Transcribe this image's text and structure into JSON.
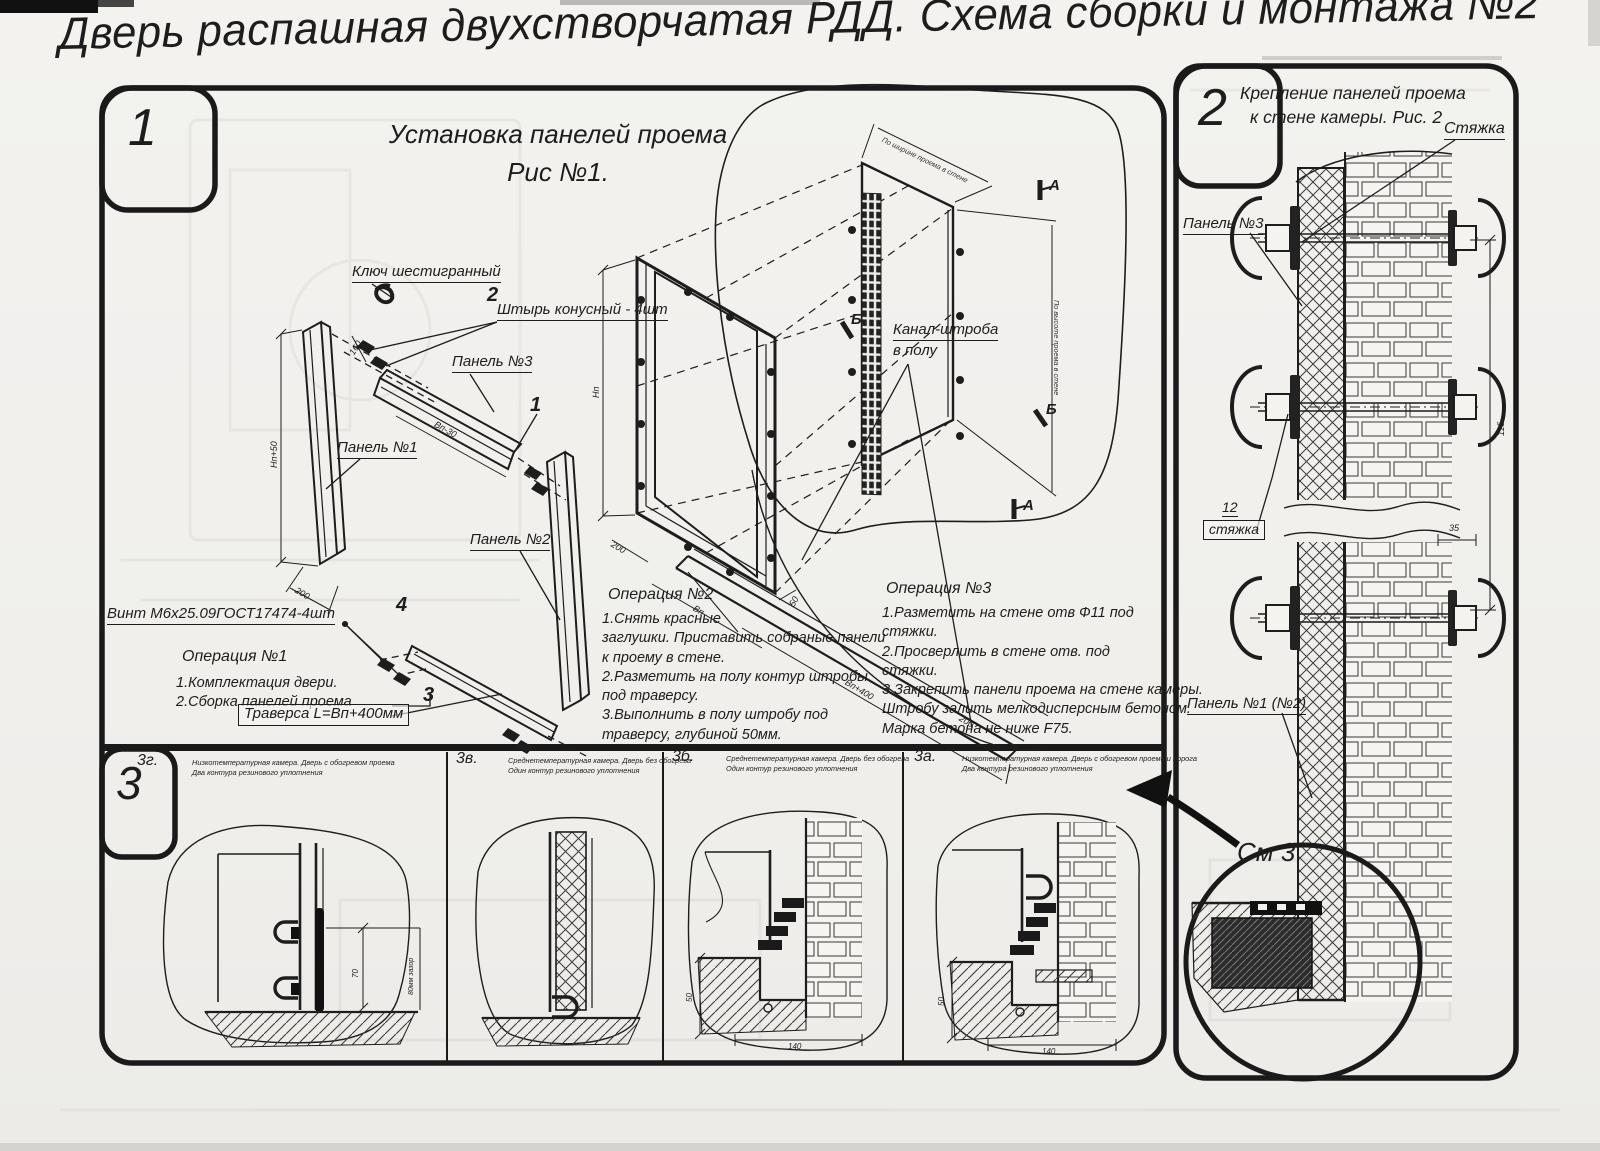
{
  "title": "Дверь распашная двухстворчатая РДД.  Схема сборки и монтажа №2",
  "section1": {
    "number": "1",
    "fig_title_1": "Установка панелей проема",
    "fig_title_2": "Рис №1.",
    "labels": {
      "hex_key": "Ключ шестигранный",
      "pin_num": "2",
      "pin": "Штырь конусный - 4шт",
      "panel3": "Панель №3",
      "panel1_num": "1",
      "panel1": "Панель №1",
      "panel2": "Панель №2",
      "screw_num": "4",
      "screw": "Винт М6х25.09ГОСТ17474-4шт",
      "traverse_num": "3",
      "traverse": "Траверса  L=Вп+400мм",
      "channel_1": "Канал-штроба",
      "channel_2": "в полу",
      "marker_a": "А",
      "marker_b": "Б"
    },
    "ops": {
      "op1_title": "Операция №1",
      "op1_text": "1.Комплектация двери.\n2.Сборка панелей проема",
      "op2_title": "Операция №2",
      "op2_text": "1.Снять красные\nзаглушки. Приставить собраные панели\nк проему в стене.\n2.Разметить на полу контур штробы\nпод траверсу.\n3.Выполнить в полу штробу под\nтраверсу, глубиной 50мм.",
      "op3_title": "Операция №3",
      "op3_text": "1.Разметить на стене отв Ф11 под\nстяжки.\n2.Просверлить в стене отв.  под\nстяжки.\n3.Закрепить панели проема на стене камеры.\nШтробу залить мелкодисперсным бетоном.\nМарка бетона не ниже  F75."
    },
    "dims": {
      "hp50": "Нп+50",
      "d200a": "200",
      "vp30": "Вп-30",
      "d160": "160",
      "np": "Нп",
      "d200b": "200",
      "vp": "Вп",
      "d50": "50",
      "vp400": "Вп+400",
      "d200c": "200",
      "width_note": "По ширине проема в стене",
      "height_note": "По высоте проема в стене"
    }
  },
  "section2": {
    "number": "2",
    "title_1": "Крепление панелей проема",
    "title_2": "к стене камеры. Рис. 2",
    "labels": {
      "tie": "Стяжка",
      "panel3": "Панель №3",
      "tie12_num": "12",
      "tie12": "стяжка",
      "panel12": "Панель №1 (№2)",
      "see_detail": "См 3"
    },
    "dims": {
      "d35": "35",
      "d115": "115"
    }
  },
  "section3": {
    "number": "3",
    "views": [
      {
        "id": "3г.",
        "desc": "Низкотемпературная камера. Дверь с обогревом проема\nДва контура резинового уплотнения"
      },
      {
        "id": "3в.",
        "desc": "Среднетемпературная камера. Дверь без обогрева\nОдин контур резинового уплотнения"
      },
      {
        "id": "3б.",
        "desc": "Среднетемпературная камера. Дверь без обогрева\nОдин контур резинового уплотнения"
      },
      {
        "id": "3а.",
        "desc": "Низкотемпературная камера. Дверь с обогревом проема и порога\nДва контура резинового уплотнения"
      }
    ],
    "dims": {
      "d70": "70",
      "gap": "80мм зазор",
      "b50": "50",
      "b140": "140",
      "a50": "50",
      "a140": "140"
    }
  }
}
